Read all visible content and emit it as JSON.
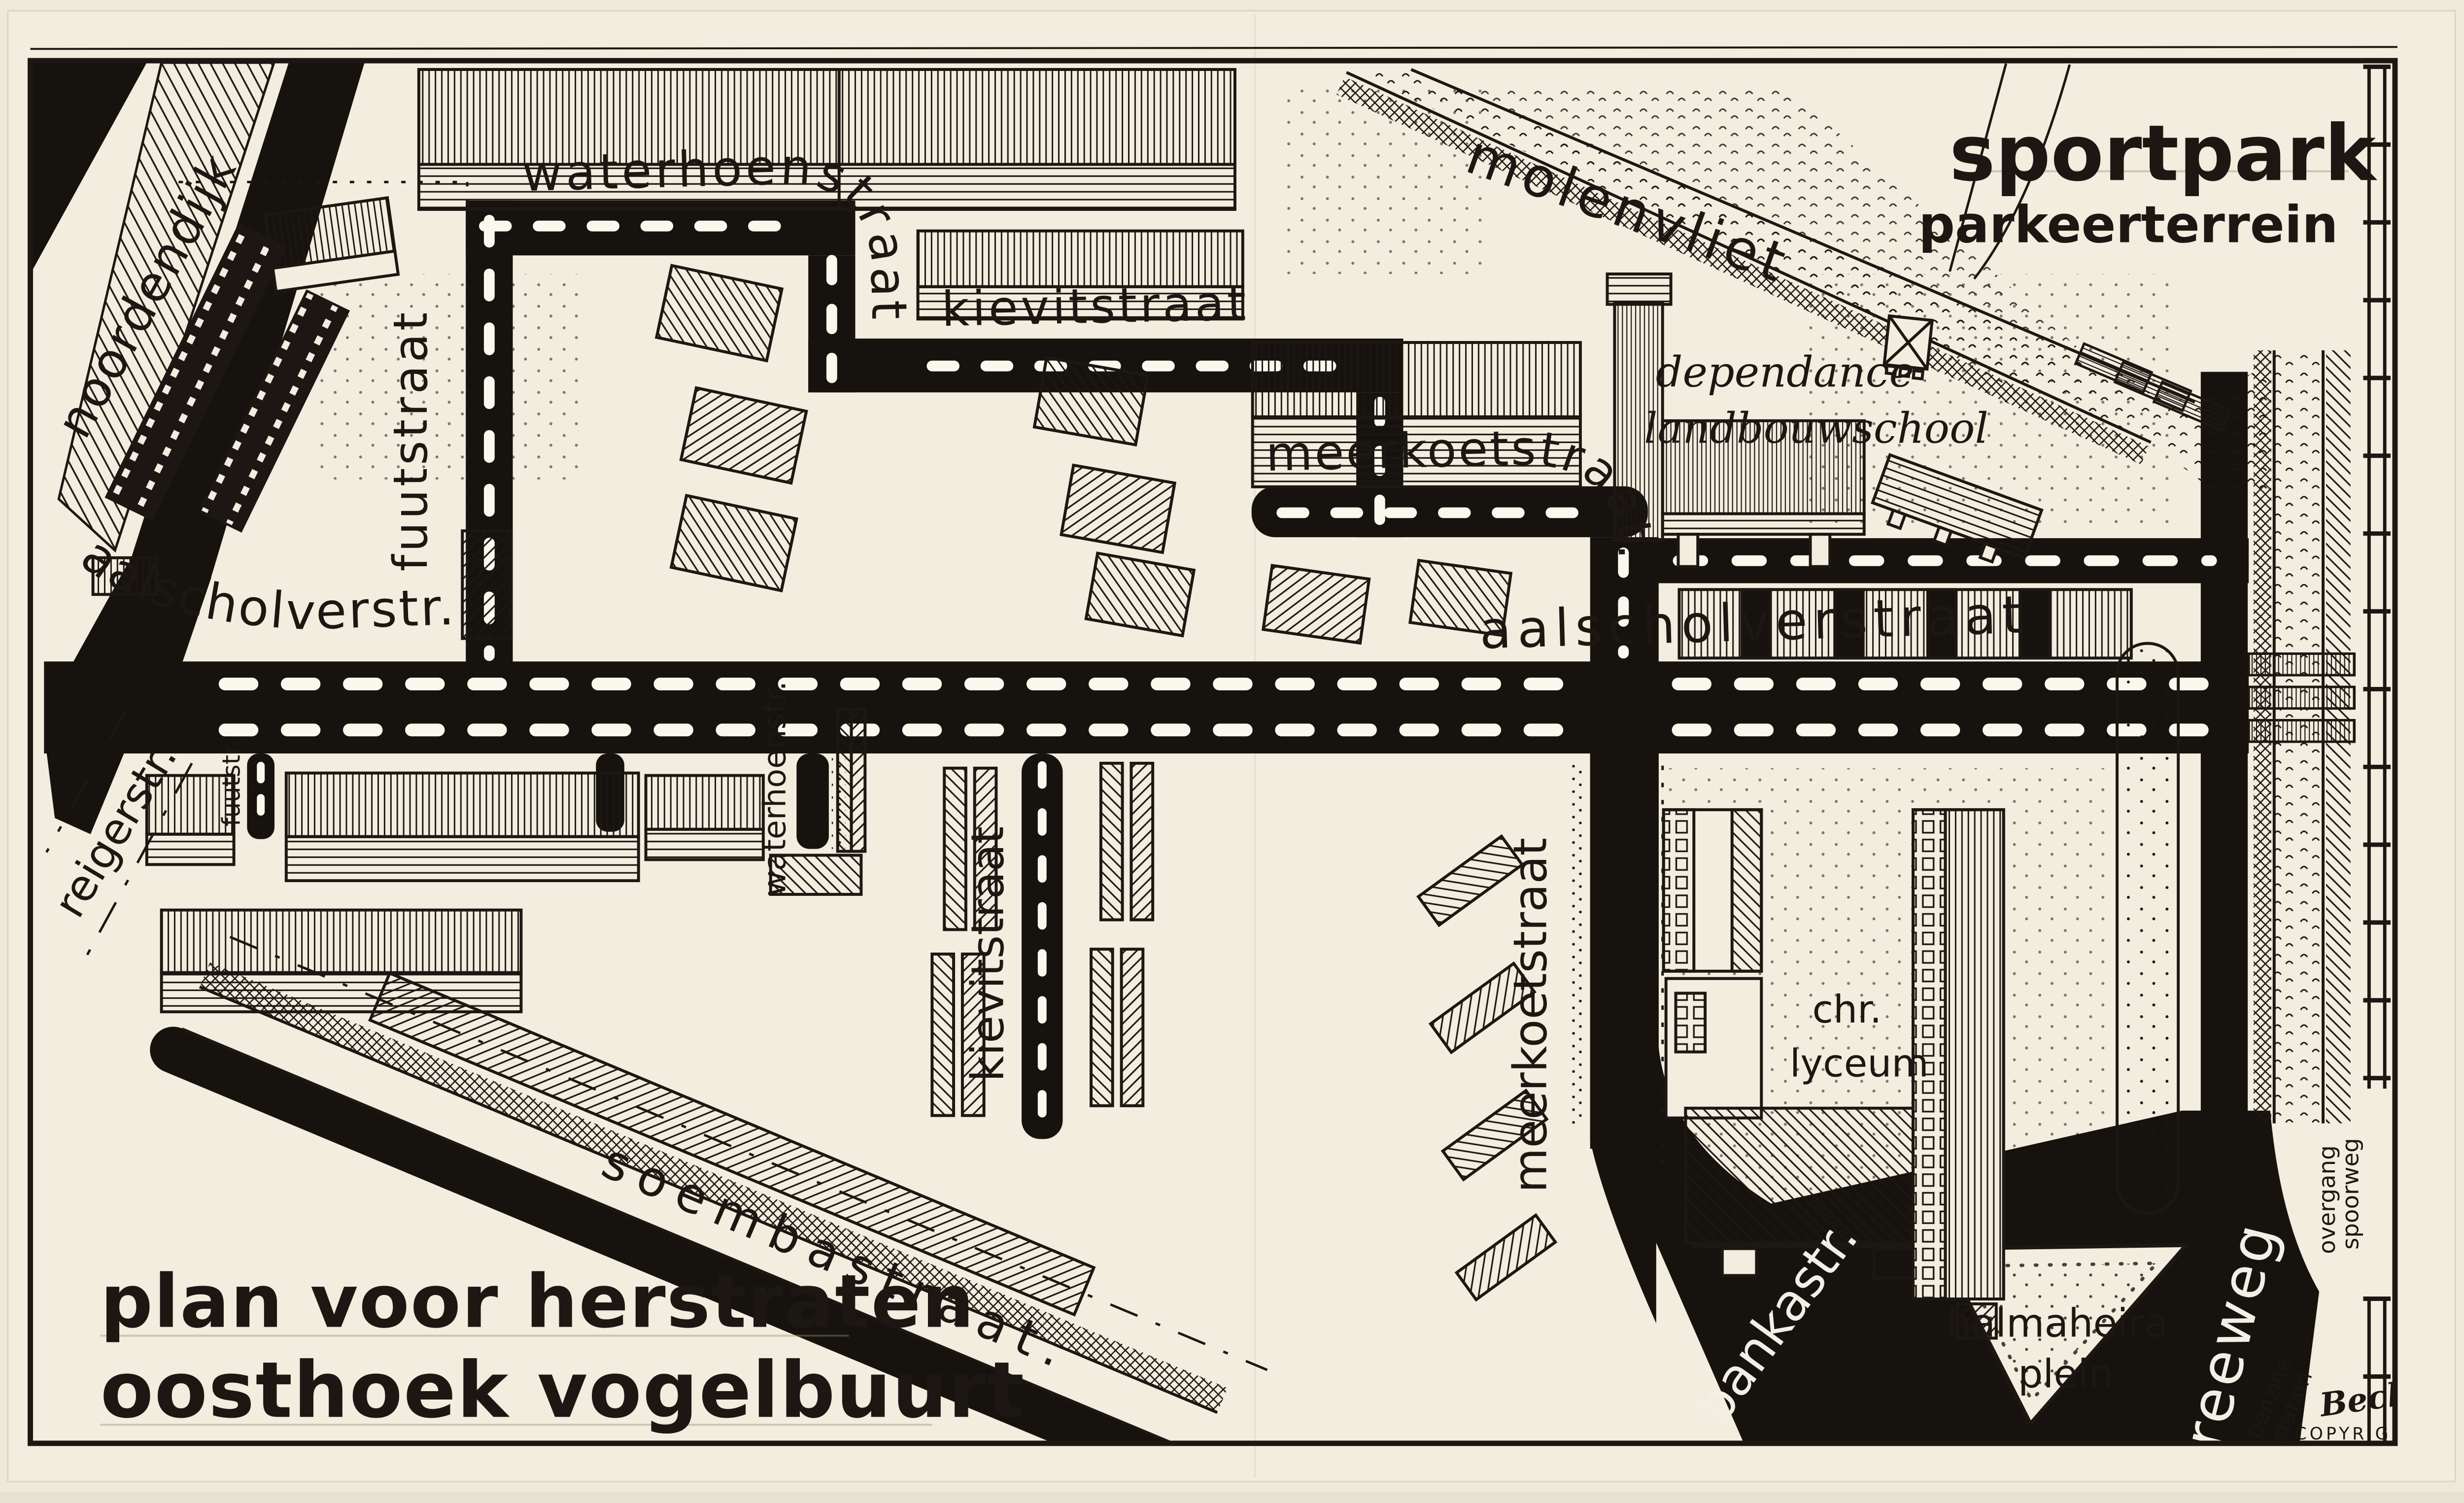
{
  "title": {
    "line1": "plan voor herstraten",
    "line2": "oosthoek vogelbuurt"
  },
  "streets": {
    "noordendijk": "noordendijk",
    "waterhoenstraat": "waterhoenstraat",
    "kievitstraat": "kievitstraat",
    "meerkoetstraat": "meerkoetstraat.",
    "aalscholverstr": "aalscholverstr.",
    "aalscholverstraat": "aalscholverstraat",
    "fuutstraat": "fuutstraat",
    "fuutstr": "fuutstr.",
    "reigerstr": "reigerstr.",
    "waterhoenstr": "waterhoenstr.",
    "kievitstraat_zuid": "kievitstraat",
    "meerkoetstraat_zuid": "meerkoetstraat",
    "soembastraat": "soembastraat.",
    "bankastr": "bankastr.",
    "reeweg": "reeweg",
    "molenvliet": "molenvliet"
  },
  "areas": {
    "sportpark": "sportpark",
    "parkeerterrein": "parkeerterrein",
    "dependance_line1": "dependance",
    "dependance_line2": "landbouwschool",
    "lyceum_line1": "chr.",
    "lyceum_line2": "lyceum",
    "plein_line1": "halmaheira",
    "plein_line2": "plein",
    "benzine_line1": "benzine",
    "benzine_line2": "station",
    "spoorweg_line1": "spoorweg",
    "spoorweg_line2": "overgang"
  },
  "credits": {
    "signature": "Beckman",
    "copyright": "COPYRIGHT"
  },
  "colors": {
    "paper": "#f2edde",
    "ink": "#1c1712",
    "road": "#16120d",
    "label_white": "#f2efe4"
  }
}
